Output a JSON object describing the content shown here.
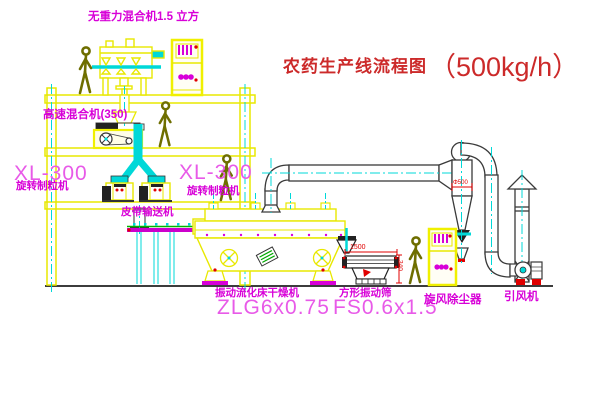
{
  "diagram": {
    "title": "农药生产线流程图",
    "title_capacity": "（500kg/h）"
  },
  "equipment_labels": {
    "gravity_free_mixer": "无重力混合机1.5 立方",
    "high_speed_mixer": "高速混合机(350)",
    "granulator_left_model": "XL-300",
    "granulator_left_name": "旋转制粒机",
    "granulator_right_model": "XL-300",
    "granulator_right_name": "旋转制粒机",
    "belt_conveyor": "皮带输送机",
    "fluid_bed_dryer_name": "振动流化床干燥机",
    "fluid_bed_dryer_model": "ZLG6x0.75",
    "vibrating_sieve_name": "方形振动筛",
    "vibrating_sieve_model": "FS0.6x1.5",
    "cyclone_dust_collector": "旋风除尘器",
    "induced_draft_fan": "引风机"
  },
  "dimensions": {
    "sieve_length": "1500",
    "sieve_height": "340",
    "cyclone_diameter": "Φ500"
  },
  "colors": {
    "drawing_yellow": "#e8e800",
    "centerline_cyan": "#00d8d8",
    "label_magenta": "#d800d8",
    "model_magenta": "#e85ae8",
    "title_red": "#cc2a2a",
    "dimension_red": "#e00000",
    "pipe_dark": "#3a3a3a",
    "belt_green": "#00b400"
  }
}
